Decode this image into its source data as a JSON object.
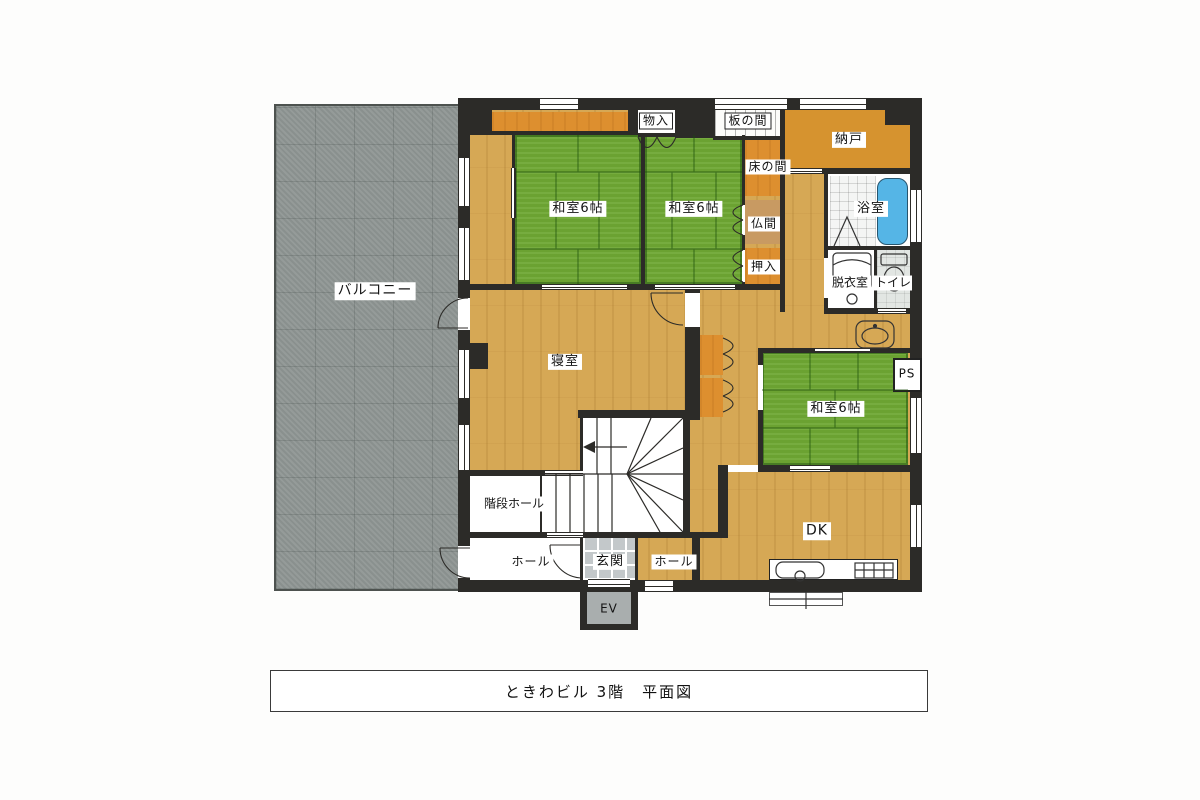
{
  "title_block": {
    "text": "ときわビル 3階　平面図"
  },
  "rooms": {
    "balcony": {
      "label": "バルコニー"
    },
    "storage_top": {
      "label": "物入"
    },
    "itanoma": {
      "label": "板の間"
    },
    "nando": {
      "label": "納戸"
    },
    "tokonoma": {
      "label": "床の間"
    },
    "washitsu_1": {
      "label": "和室6帖"
    },
    "washitsu_2": {
      "label": "和室6帖"
    },
    "washitsu_3": {
      "label": "和室6帖"
    },
    "bathroom": {
      "label": "浴室"
    },
    "butsuma": {
      "label": "仏間"
    },
    "oshiire": {
      "label": "押入"
    },
    "dressing_room": {
      "label": "脱衣室"
    },
    "toilet": {
      "label": "トイレ"
    },
    "bedroom": {
      "label": "寝室"
    },
    "pipe_space": {
      "label": "PS"
    },
    "dk": {
      "label": "DK"
    },
    "stair_hall": {
      "label": "階段ホール"
    },
    "hall_west": {
      "label": "ホール"
    },
    "genkan": {
      "label": "玄関"
    },
    "hall_east": {
      "label": "ホール"
    },
    "elevator": {
      "label": "EV"
    }
  },
  "colors": {
    "wall": "#2c2b28",
    "wood_floor": "#d6a855",
    "tatami_green": "#6ea733",
    "closet_orange": "#dd8f2f",
    "balcony_gray": "#8f9694",
    "entry_tile": "#c3c8ca",
    "bathtub_blue": "#55b5e6"
  }
}
